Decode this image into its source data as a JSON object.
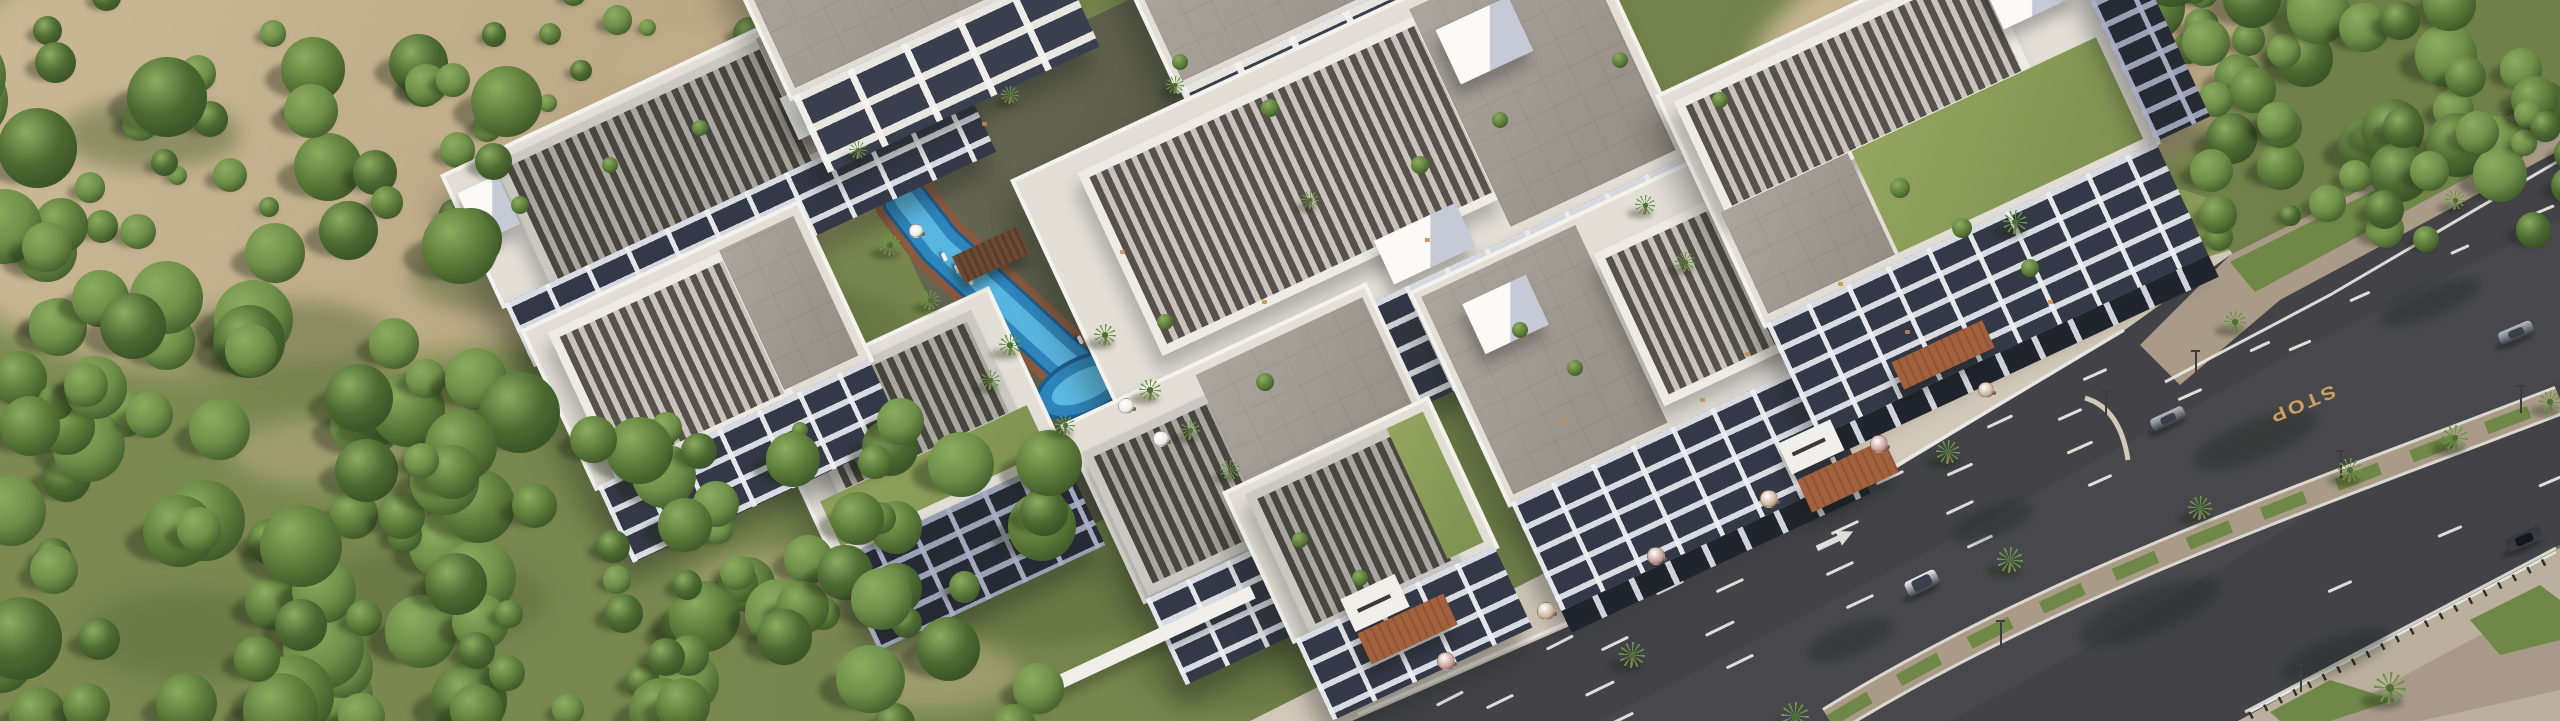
{
  "road": {
    "stop_marking": "STOP"
  },
  "colors": {
    "bg": "#7d8b52",
    "dirt1": "#cdbb98",
    "dirt2": "#b3a07d",
    "treeDark": "#2f4720",
    "tree1": "#4d6a32",
    "tree2": "#5e7d3b",
    "tree3": "#6f9049",
    "treeHi": "#8dac60",
    "asphalt": "#424247",
    "asphalt2": "#4b4b52",
    "lane": "#ebebe8",
    "stop": "#c9a35f",
    "cobble": "#a99b88",
    "paver": "#bbaf9d",
    "grassStrip": "#6f8747",
    "walk": "#d2c9ba",
    "pool1": "#2f86bd",
    "pool2": "#64c2ea",
    "poolRim": "#1d5f8e",
    "poolDeck": "#8a5a40",
    "terra": "#a2603c",
    "umbPink": "#c89e94",
    "umbTan": "#cdb499",
    "umbWhite": "#efede6",
    "carWhite": "#f2f3f5",
    "carSilver": "#b9bdc4",
    "carDark": "#34373e",
    "trunk": "#7d6a50",
    "palm1": "#497233",
    "palm2": "#6b9646",
    "lamp": "#3d3d3d",
    "litwin": "#c98b45"
  },
  "scene": {
    "forest": [
      {
        "x": -40,
        "y": 60,
        "w": 560,
        "h": 660,
        "n": 95,
        "rmin": 16,
        "rmax": 42,
        "seed": 7,
        "z": 36
      },
      {
        "x": 420,
        "y": 420,
        "w": 640,
        "h": 310,
        "n": 60,
        "rmin": 14,
        "rmax": 36,
        "seed": 11,
        "z": 36
      },
      {
        "x": 40,
        "y": -20,
        "w": 720,
        "h": 250,
        "n": 26,
        "rmin": 8,
        "rmax": 18,
        "seed": 23,
        "z": 4
      },
      {
        "x": 1950,
        "y": -30,
        "w": 620,
        "h": 210,
        "n": 52,
        "rmin": 14,
        "rmax": 34,
        "seed": 31,
        "z": 22
      },
      {
        "x": 2190,
        "y": 120,
        "w": 380,
        "h": 120,
        "n": 18,
        "rmin": 10,
        "rmax": 22,
        "seed": 43,
        "z": 22
      },
      {
        "x": 1865,
        "y": 20,
        "w": 120,
        "h": 90,
        "n": 4,
        "rmin": 22,
        "rmax": 34,
        "seed": 5,
        "z": 22
      }
    ],
    "grass_patches": [
      [
        170,
        300,
        230,
        90
      ],
      [
        410,
        240,
        190,
        75
      ],
      [
        640,
        410,
        210,
        85
      ],
      [
        290,
        550,
        260,
        100
      ],
      [
        80,
        590,
        210,
        90
      ],
      [
        740,
        290,
        170,
        65
      ],
      [
        930,
        550,
        230,
        95
      ],
      [
        1130,
        620,
        220,
        90
      ],
      [
        560,
        120,
        160,
        60
      ],
      [
        60,
        100,
        180,
        70
      ]
    ],
    "dirt_patches": [
      [
        230,
        420,
        170,
        65
      ],
      [
        510,
        290,
        150,
        55
      ],
      [
        690,
        550,
        190,
        75
      ],
      [
        110,
        170,
        210,
        85
      ],
      [
        840,
        640,
        180,
        70
      ],
      [
        360,
        60,
        200,
        80
      ],
      [
        620,
        30,
        170,
        70
      ]
    ],
    "road_dashes": [
      [
        1450,
        697,
        30,
        -27
      ],
      [
        1560,
        641,
        30,
        -27
      ],
      [
        1670,
        586,
        30,
        -26
      ],
      [
        1780,
        531,
        30,
        -26
      ],
      [
        1890,
        476,
        30,
        -25
      ],
      [
        2000,
        420,
        28,
        -25
      ],
      [
        2095,
        373,
        26,
        -24
      ],
      [
        1500,
        700,
        30,
        -26
      ],
      [
        1615,
        642,
        30,
        -26
      ],
      [
        1730,
        584,
        30,
        -25
      ],
      [
        1845,
        526,
        30,
        -25
      ],
      [
        1960,
        468,
        28,
        -24
      ],
      [
        2070,
        413,
        26,
        -24
      ],
      [
        1600,
        687,
        32,
        -26
      ],
      [
        1720,
        627,
        32,
        -26
      ],
      [
        1840,
        567,
        30,
        -25
      ],
      [
        1960,
        506,
        30,
        -25
      ],
      [
        2080,
        446,
        28,
        -24
      ],
      [
        2190,
        393,
        26,
        -24
      ],
      [
        2300,
        344,
        24,
        -23
      ],
      [
        1620,
        718,
        30,
        -26
      ],
      [
        1740,
        660,
        30,
        -26
      ],
      [
        1860,
        600,
        30,
        -25
      ],
      [
        1980,
        540,
        28,
        -25
      ],
      [
        2100,
        479,
        26,
        -24
      ],
      [
        2340,
        585,
        26,
        -24
      ],
      [
        2450,
        530,
        26,
        -23
      ],
      [
        2550,
        480,
        24,
        -23
      ],
      [
        2260,
        345,
        22,
        -25
      ],
      [
        2360,
        295,
        22,
        -24
      ],
      [
        2460,
        248,
        20,
        -24
      ],
      [
        2545,
        208,
        20,
        -23
      ]
    ],
    "road_shadows": [
      [
        2255,
        440,
        130,
        38
      ],
      [
        2150,
        612,
        150,
        42
      ],
      [
        2335,
        655,
        115,
        34
      ],
      [
        1992,
        522,
        85,
        28
      ],
      [
        2430,
        302,
        105,
        28
      ],
      [
        1850,
        640,
        90,
        30
      ]
    ],
    "cars": [
      {
        "x": 1905,
        "y": 575,
        "type": "suv",
        "color": "white",
        "angle": -26
      },
      {
        "x": 2150,
        "y": 412,
        "type": "coupe",
        "color": "silver",
        "angle": -25
      },
      {
        "x": 2498,
        "y": 326,
        "type": "coupe",
        "color": "silver",
        "angle": -23
      },
      {
        "x": 2505,
        "y": 532,
        "type": "sedan",
        "color": "dark",
        "angle": -23
      }
    ],
    "palms": [
      [
        2010,
        560,
        13
      ],
      [
        2200,
        508,
        12
      ],
      [
        2350,
        470,
        12
      ],
      [
        2455,
        438,
        13
      ],
      [
        2550,
        402,
        11
      ],
      [
        2235,
        322,
        11
      ],
      [
        2455,
        200,
        10
      ],
      [
        2015,
        222,
        12
      ],
      [
        2390,
        688,
        16
      ],
      [
        1632,
        655,
        13
      ],
      [
        1948,
        452,
        12
      ],
      [
        1795,
        716,
        14
      ],
      [
        890,
        245,
        11
      ],
      [
        930,
        300,
        10
      ],
      [
        1010,
        345,
        11
      ],
      [
        1105,
        335,
        11
      ],
      [
        1150,
        390,
        11
      ],
      [
        1190,
        430,
        10
      ],
      [
        1230,
        470,
        10
      ],
      [
        1065,
        425,
        10
      ],
      [
        990,
        380,
        10
      ],
      [
        858,
        150,
        9
      ],
      [
        1645,
        205,
        10
      ],
      [
        1685,
        262,
        10
      ],
      [
        1310,
        200,
        9
      ],
      [
        1175,
        85,
        9
      ],
      [
        1010,
        95,
        9
      ]
    ],
    "umbrellas": [
      [
        1445,
        660,
        8,
        "pink"
      ],
      [
        1545,
        610,
        8,
        "tan"
      ],
      [
        1655,
        555,
        8,
        "pink"
      ],
      [
        1768,
        498,
        8,
        "tan"
      ],
      [
        1878,
        443,
        8,
        "pink"
      ],
      [
        1985,
        389,
        7,
        "tan"
      ],
      [
        1125,
        405,
        7,
        "white"
      ],
      [
        1160,
        438,
        7,
        "white"
      ],
      [
        915,
        230,
        6,
        "white"
      ]
    ],
    "lamps": [
      [
        2195,
        378
      ],
      [
        2105,
        418
      ],
      [
        2000,
        648
      ],
      [
        2340,
        478
      ],
      [
        2520,
        413
      ],
      [
        2300,
        692
      ]
    ],
    "loungers": [
      [
        1098,
        362
      ],
      [
        1112,
        374
      ],
      [
        1126,
        386
      ],
      [
        1140,
        398
      ],
      [
        1155,
        412
      ],
      [
        1170,
        426
      ],
      [
        1185,
        440
      ],
      [
        1076,
        338
      ],
      [
        1090,
        350
      ],
      [
        1210,
        468
      ],
      [
        1224,
        481
      ],
      [
        940,
        255
      ],
      [
        953,
        267
      ],
      [
        966,
        279
      ]
    ],
    "roof_plants": [
      [
        520,
        205,
        9
      ],
      [
        610,
        165,
        8
      ],
      [
        1180,
        62,
        8
      ],
      [
        1270,
        108,
        9
      ],
      [
        1420,
        165,
        9
      ],
      [
        1500,
        120,
        8
      ],
      [
        1165,
        322,
        8
      ],
      [
        1265,
        382,
        9
      ],
      [
        1900,
        188,
        10
      ],
      [
        1962,
        228,
        10
      ],
      [
        2030,
        268,
        9
      ],
      [
        1520,
        330,
        8
      ],
      [
        1575,
        368,
        8
      ],
      [
        800,
        430,
        8
      ],
      [
        868,
        468,
        8
      ],
      [
        1300,
        540,
        8
      ],
      [
        1360,
        578,
        8
      ],
      [
        700,
        128,
        8
      ],
      [
        1620,
        60,
        8
      ],
      [
        1720,
        100,
        8
      ]
    ],
    "lit_windows": [
      [
        1262,
        300
      ],
      [
        1425,
        238
      ],
      [
        1700,
        398
      ],
      [
        1745,
        352
      ],
      [
        2048,
        300
      ],
      [
        982,
        122
      ],
      [
        1560,
        420
      ],
      [
        1838,
        282
      ],
      [
        1905,
        330
      ],
      [
        1120,
        250
      ]
    ]
  }
}
